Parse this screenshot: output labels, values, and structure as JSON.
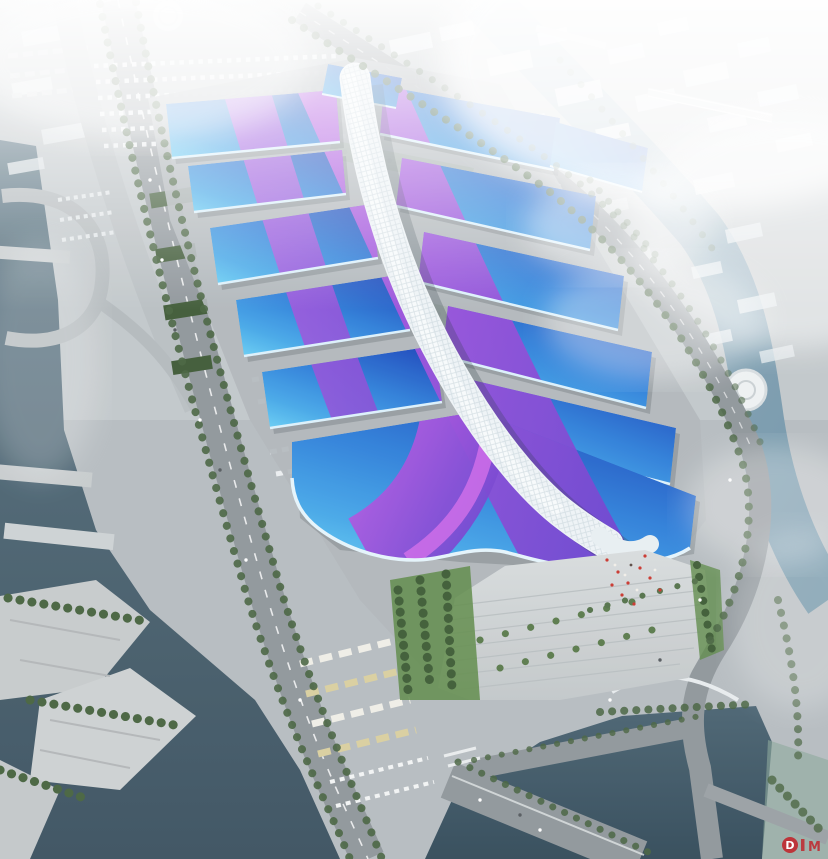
{
  "scene": {
    "alt": "Aerial rendering of a large exhibition convention center with blue wave roofs crossed by purple ribbon bands and a white quilted central spine canopy, surrounded by roads, parking lots, rivers and hazy white city blocks"
  },
  "palette": {
    "hall_blue_deep": "#1c49bc",
    "hall_blue": "#2e7fd9",
    "hall_cyan": "#63c8f2",
    "band_magenta": "#c05ce4",
    "band_violet": "#6f42cf",
    "spine_light": "#f6fafc",
    "spine_shade": "#c6d4dc",
    "ground": "#b6bcc0",
    "plaza": "#d8dcdd",
    "road": "#8f969b",
    "water_dark": "#3c5260",
    "water_mid": "#5a7482",
    "river_light": "#9ab4c4",
    "green_roof": "#3f5a37",
    "tree_green": "#47633f",
    "lawn_green": "#5e8a48",
    "haze_white": "#ffffff",
    "watermark_red": "#c0272d",
    "people_red": "#c9372e"
  },
  "watermark": {
    "mark": "D",
    "tail": "M"
  }
}
